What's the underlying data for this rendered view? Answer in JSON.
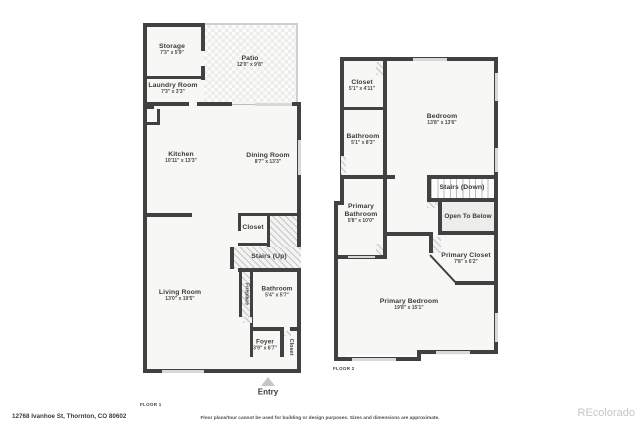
{
  "page": {
    "address": "12768 Ivanhoe St, Thornton, CO 80602",
    "disclaimer": "Floor plans/tour cannot be used for building or design purposes. Sizes and dimensions are approximate.",
    "brand": "REcolorado"
  },
  "colors": {
    "wall": "#414141",
    "floor_fill": "#f7f7f5",
    "window": "#d9d9d9",
    "brand_text": "#c7c7c9"
  },
  "floor1": {
    "tag": "FLOOR 1",
    "entry": "Entry",
    "storage": {
      "name": "Storage",
      "dims": "7'3\" x 5'9\""
    },
    "patio": {
      "name": "Patio",
      "dims": "12'0\" x 9'8\""
    },
    "laundry": {
      "name": "Laundry Room",
      "dims": "7'3\" x 3'3\""
    },
    "kitchen": {
      "name": "Kitchen",
      "dims": "10'11\" x 13'3\""
    },
    "dining": {
      "name": "Dining Room",
      "dims": "8'7\" x 13'3\""
    },
    "closet": {
      "name": "Closet"
    },
    "stairs": {
      "name": "Stairs (Up)"
    },
    "living": {
      "name": "Living Room",
      "dims": "13'0\" x 19'5\""
    },
    "fireplace": {
      "name": "Fireplace"
    },
    "bathroom": {
      "name": "Bathroom",
      "dims": "5'4\" x 5'7\""
    },
    "foyer": {
      "name": "Foyer",
      "dims": "3'9\" x 6'7\""
    },
    "foyer_closet": {
      "name": "Closet"
    }
  },
  "floor2": {
    "tag": "FLOOR 2",
    "closet": {
      "name": "Closet",
      "dims": "5'1\" x 4'11\""
    },
    "bathroom": {
      "name": "Bathroom",
      "dims": "5'1\" x 8'3\""
    },
    "bedroom": {
      "name": "Bedroom",
      "dims": "13'8\" x 13'6\""
    },
    "stairs": {
      "name": "Stairs (Down)"
    },
    "open_to_below": {
      "name": "Open To Below"
    },
    "primary_bathroom": {
      "name": "Primary Bathroom",
      "dims": "5'8\" x 10'0\""
    },
    "primary_closet": {
      "name": "Primary Closet",
      "dims": "7'8\" x 6'2\""
    },
    "primary_bedroom": {
      "name": "Primary Bedroom",
      "dims": "19'8\" x 15'1\""
    }
  }
}
